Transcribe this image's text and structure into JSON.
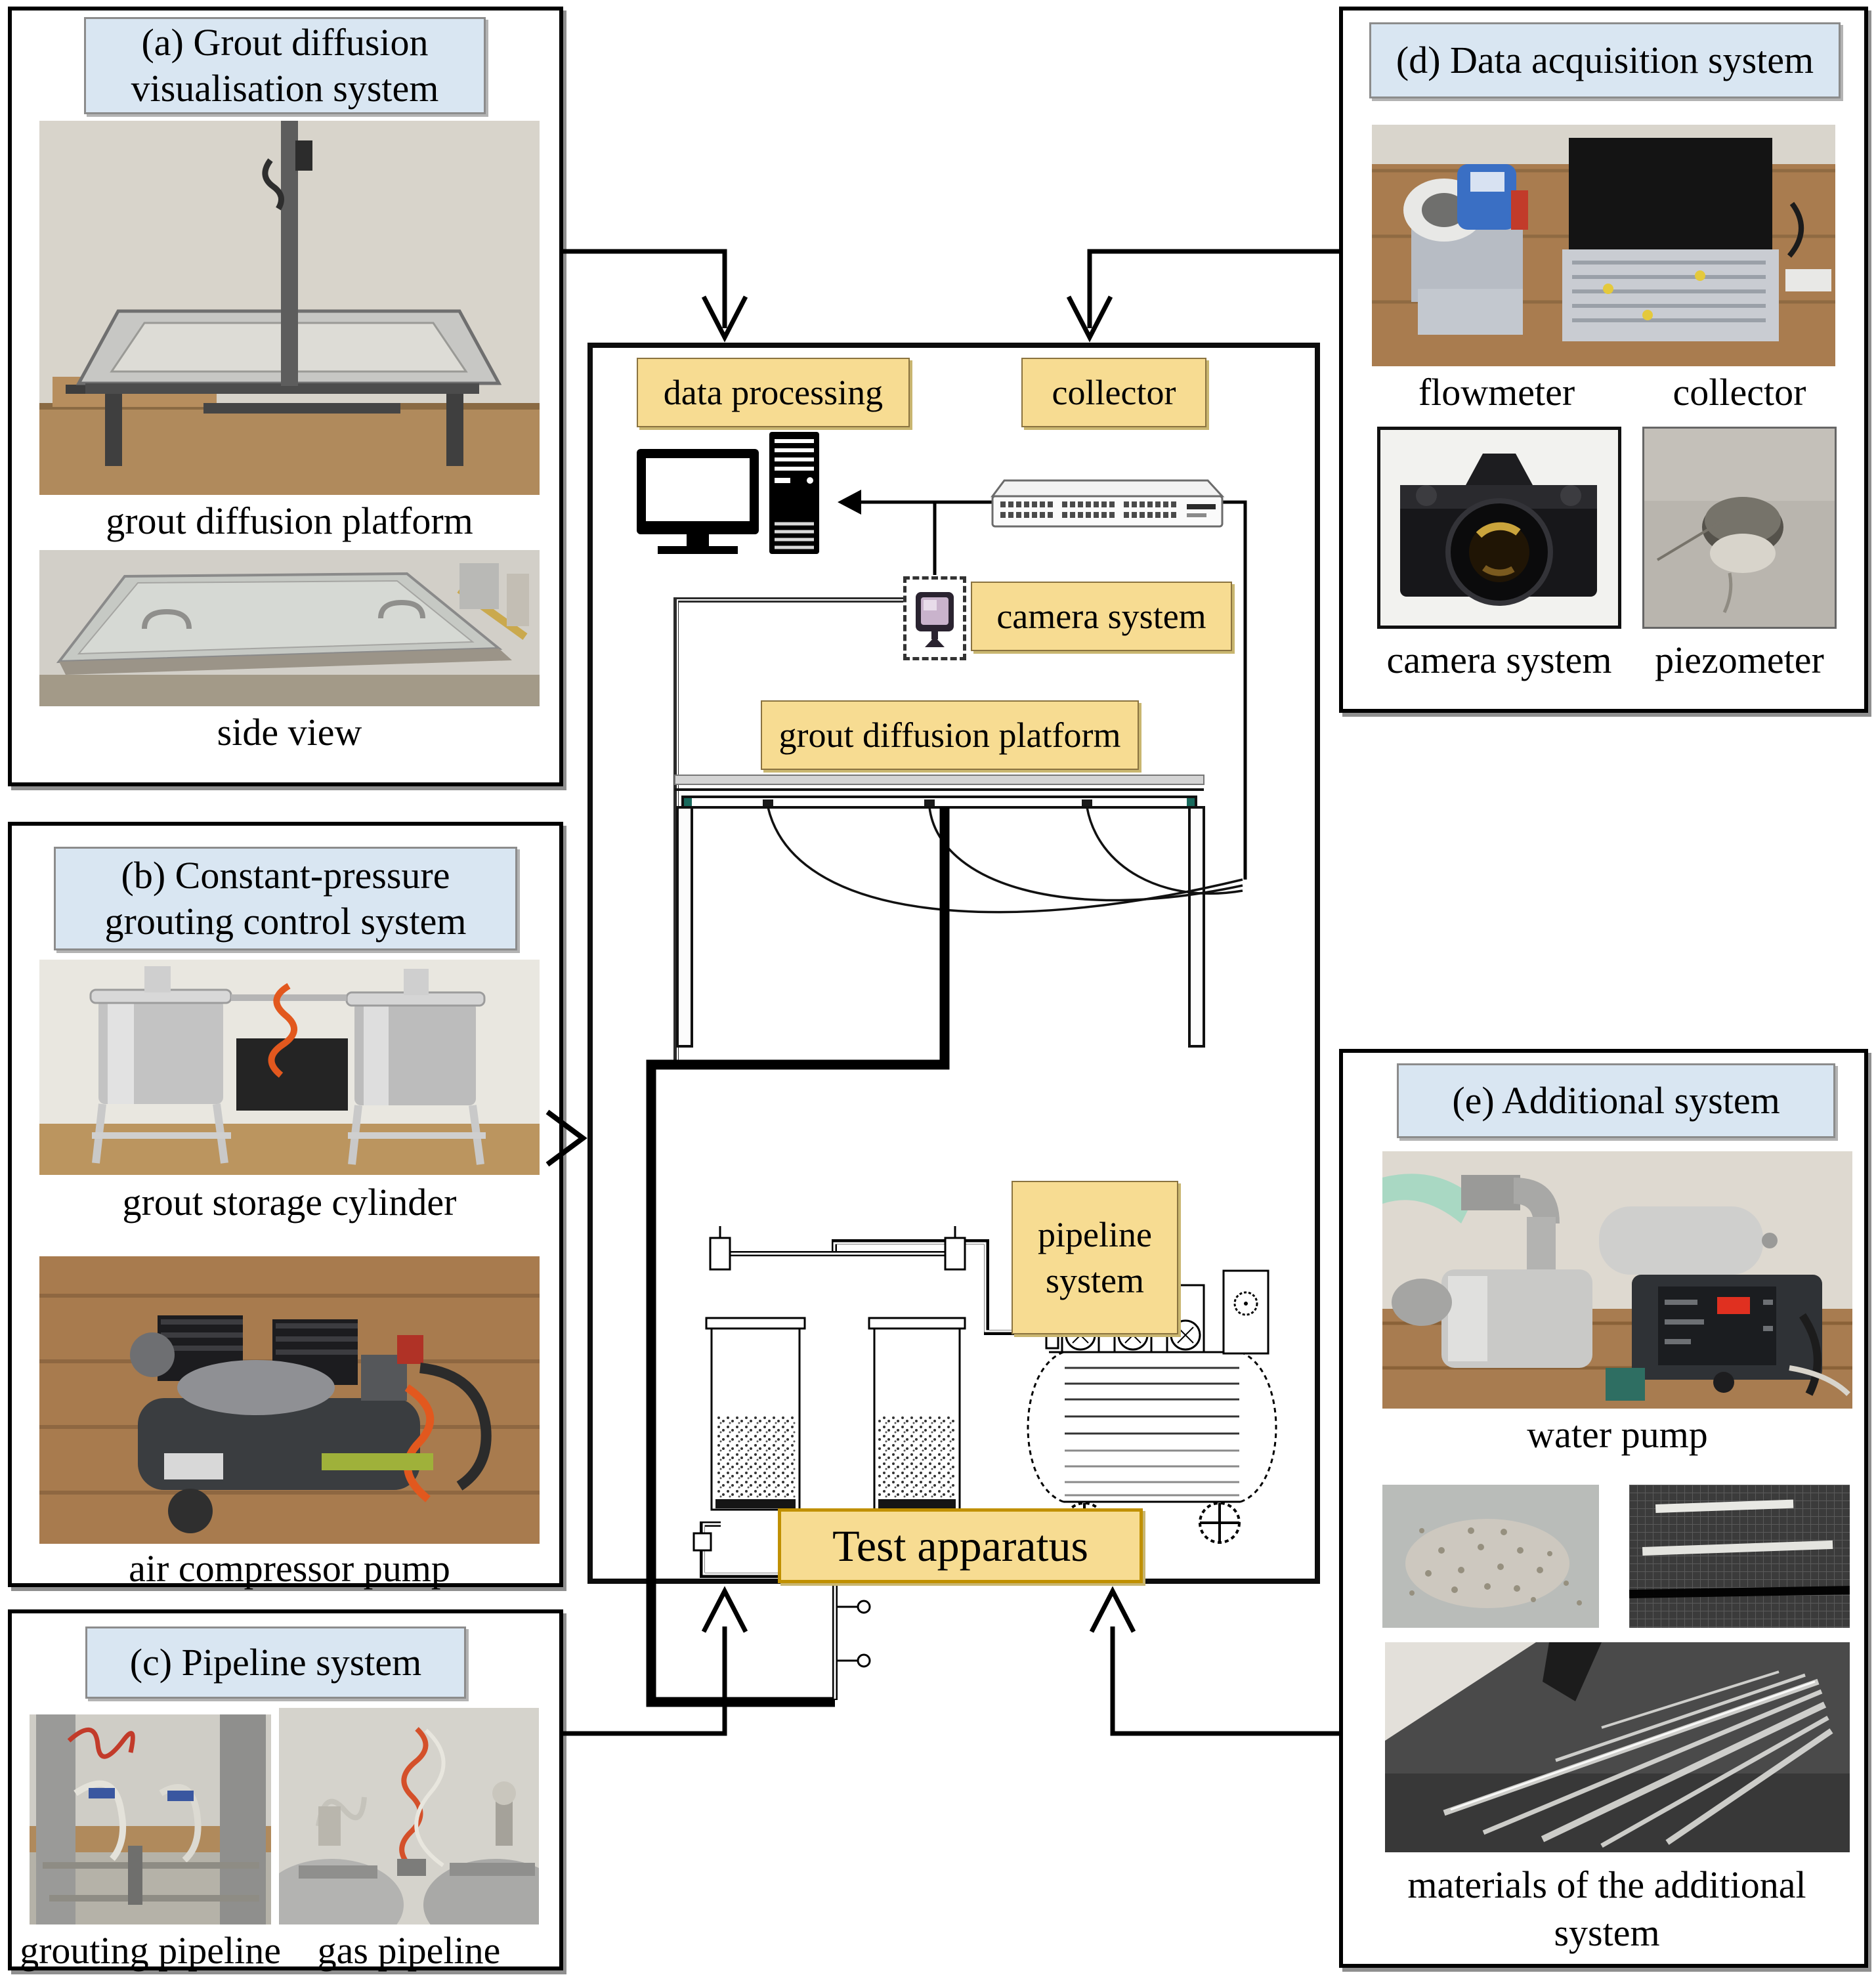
{
  "figure": {
    "kind": "test-apparatus-overview-diagram",
    "center_title": "Test apparatus"
  },
  "panels": {
    "a": {
      "title_l1": "(a) Grout diffusion",
      "title_l2": "visualisation system",
      "captions": [
        "grout diffusion platform",
        "side view"
      ]
    },
    "b": {
      "title_l1": "(b) Constant-pressure",
      "title_l2": "grouting control system",
      "captions": [
        "grout storage cylinder",
        "air compressor pump"
      ]
    },
    "c": {
      "title": "(c) Pipeline system",
      "captions": [
        "grouting pipeline",
        "gas pipeline"
      ]
    },
    "d": {
      "title": "(d) Data acquisition system",
      "captions": [
        "flowmeter",
        "collector",
        "camera system",
        "piezometer"
      ]
    },
    "e": {
      "title": "(e) Additional system",
      "captions": [
        "water pump"
      ],
      "materials_l1": "materials of the additional",
      "materials_l2": "system"
    }
  },
  "center": {
    "data_processing": "data processing",
    "collector": "collector",
    "camera_system": "camera system",
    "platform": "grout diffusion platform",
    "pipeline_l1": "pipeline",
    "pipeline_l2": "system",
    "test_apparatus": "Test apparatus"
  },
  "icons": {
    "computer": "computer-workstation-icon",
    "switch": "data-collector-switch-icon",
    "camera": "camera-icon",
    "platform": "platform-table-drawing",
    "cylinders": "grout-cylinder-drawing",
    "compressor": "air-compressor-drawing"
  },
  "colors": {
    "header_bg": "#D9E6F2",
    "header_border": "#8C8C8C",
    "label_bg": "#F7DC92",
    "label_border": "#8A7340",
    "test_apparatus_border": "#C09000",
    "line": "#000000"
  }
}
